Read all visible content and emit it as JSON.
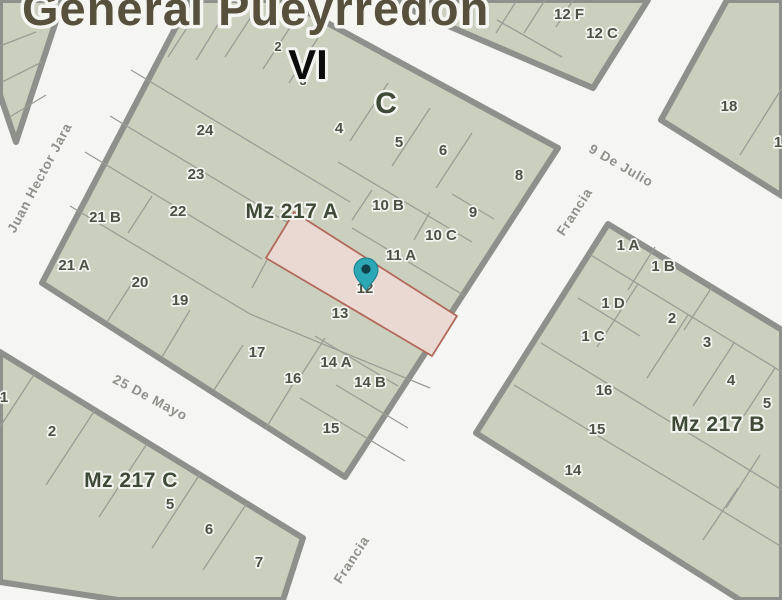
{
  "map": {
    "title": "General Pueyrredón",
    "zone_labels": {
      "district_roman": "VI",
      "zone_letter": "C"
    },
    "streets": [
      {
        "name": "Juan Hector Jara"
      },
      {
        "name": "25 De Mayo"
      },
      {
        "name": "9 De Julio"
      },
      {
        "name": "Francia"
      },
      {
        "name": "Francia"
      }
    ],
    "blocks": [
      {
        "label": "Mz 217 A",
        "parcels": [
          "2",
          "3",
          "4",
          "5",
          "6",
          "8",
          "9",
          "10 B",
          "10 C",
          "11 A",
          "12",
          "13",
          "14 A",
          "14 B",
          "15",
          "16",
          "17",
          "19",
          "20",
          "21 A",
          "21 B",
          "22",
          "23",
          "24"
        ]
      },
      {
        "label": "Mz 217 B",
        "parcels": [
          "1 A",
          "1 B",
          "1 C",
          "1 D",
          "2",
          "3",
          "4",
          "5",
          "14",
          "15",
          "16"
        ]
      },
      {
        "label": "Mz 217 C",
        "parcels": [
          "1",
          "2",
          "5",
          "6",
          "7"
        ]
      },
      {
        "label": "",
        "parcels": [
          "12 F",
          "12 C"
        ]
      },
      {
        "label": "",
        "parcels": [
          "18",
          "1"
        ]
      }
    ],
    "selected_parcel": {
      "block": "Mz 217 A",
      "label": "12",
      "marker": "location-pin"
    },
    "colors": {
      "street_background": "#f5f5f3",
      "block_fill": "#cbcfbe",
      "block_border": "#8e918b",
      "parcel_line": "#9a9d95",
      "parcel_label": "#4b5244",
      "block_label": "#3e4936",
      "street_label": "#8f908b",
      "title_text": "#57503c",
      "zone_vi_text": "#0c0c0c",
      "selected_parcel_fill": "#ead9d2",
      "selected_parcel_border": "#b2695c",
      "pin": "#2ba7b6",
      "pin_center": "#11404a"
    }
  }
}
